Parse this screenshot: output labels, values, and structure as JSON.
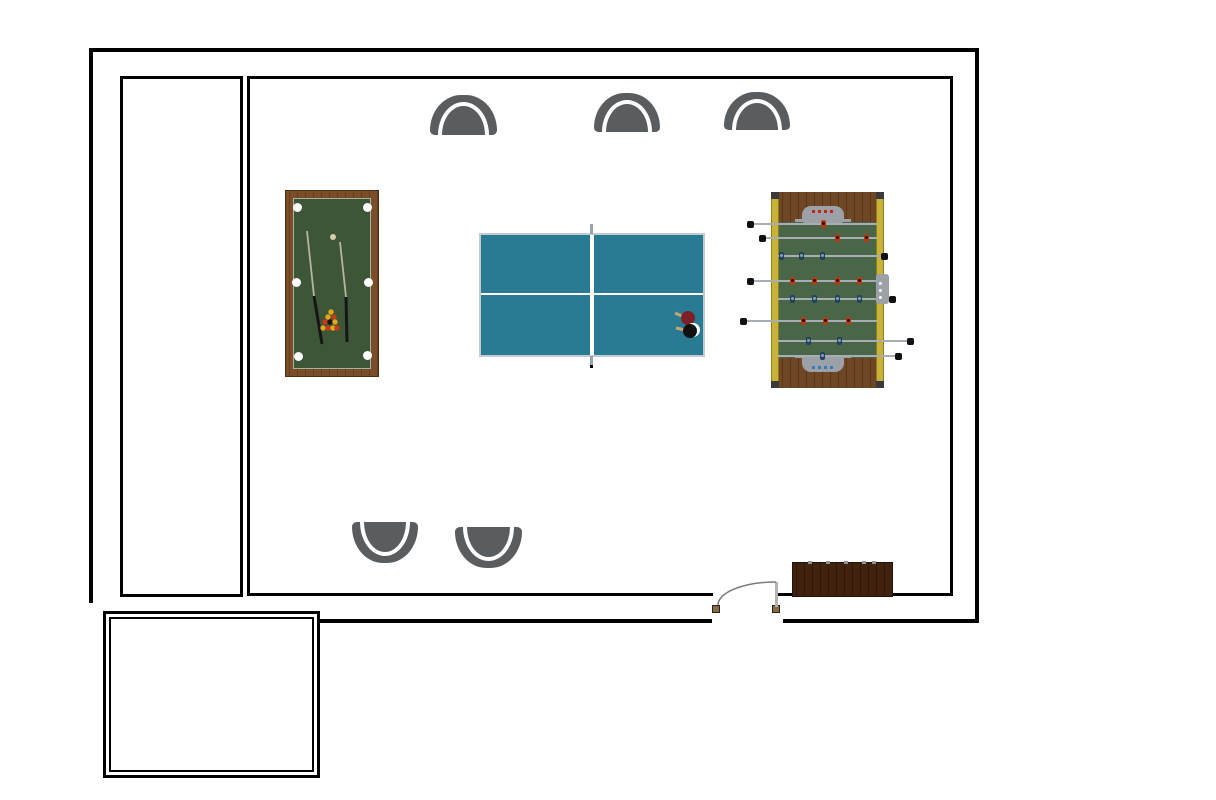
{
  "scene": {
    "title": "Game room floor plan",
    "canvas": {
      "w": 1216,
      "h": 800,
      "bg": "#ffffff"
    },
    "wall_color": "#000000",
    "walls": {
      "outer": [
        {
          "x": 89,
          "y": 48,
          "w": 890,
          "h": 4
        },
        {
          "x": 89,
          "y": 48,
          "w": 4,
          "h": 555
        },
        {
          "x": 975,
          "y": 48,
          "w": 4,
          "h": 575
        },
        {
          "x": 320,
          "y": 619,
          "w": 392,
          "h": 4
        },
        {
          "x": 783,
          "y": 619,
          "w": 196,
          "h": 4
        }
      ],
      "inner": [
        {
          "x": 120,
          "y": 76,
          "w": 123,
          "h": 3
        },
        {
          "x": 120,
          "y": 76,
          "w": 3,
          "h": 521
        },
        {
          "x": 240,
          "y": 76,
          "w": 3,
          "h": 521
        },
        {
          "x": 120,
          "y": 594,
          "w": 123,
          "h": 3
        },
        {
          "x": 247,
          "y": 76,
          "w": 706,
          "h": 3
        },
        {
          "x": 247,
          "y": 76,
          "w": 3,
          "h": 520
        },
        {
          "x": 950,
          "y": 76,
          "w": 3,
          "h": 520
        },
        {
          "x": 247,
          "y": 593,
          "w": 466,
          "h": 3
        },
        {
          "x": 778,
          "y": 593,
          "w": 175,
          "h": 3
        }
      ],
      "annex_outer": {
        "x": 103,
        "y": 611,
        "w": 217,
        "h": 167,
        "t": 3
      },
      "annex_inner": {
        "x": 109,
        "y": 617,
        "w": 205,
        "h": 155,
        "t": 2
      }
    },
    "door": {
      "jamb_color": "#8a6b3f",
      "panel_color": "#b4b4b4",
      "arc_color": "#7a7a7a",
      "jambs": [
        {
          "x": 712,
          "y": 605,
          "w": 8,
          "h": 8
        },
        {
          "x": 772,
          "y": 605,
          "w": 8,
          "h": 8
        }
      ],
      "panel": {
        "x": 775,
        "y": 582,
        "w": 3,
        "h": 25
      },
      "arc": {
        "x1": 718,
        "y1": 605,
        "x2": 776,
        "y2": 582,
        "rx": 58,
        "ry": 23
      }
    },
    "pool_table": {
      "rect": {
        "x": 285,
        "y": 190,
        "w": 94,
        "h": 187
      },
      "frame_color": "#7a4e28",
      "frame_streak": "#66401f",
      "felt": {
        "x": 293,
        "y": 198,
        "w": 78,
        "h": 171
      },
      "felt_color": "#3e5638",
      "felt_border": "#a9b0a0",
      "pocket_color": "#ffffff",
      "pocket_r": 4.5,
      "pockets": [
        {
          "x": 297,
          "y": 207
        },
        {
          "x": 367,
          "y": 207
        },
        {
          "x": 296,
          "y": 282
        },
        {
          "x": 368,
          "y": 282
        },
        {
          "x": 298,
          "y": 356
        },
        {
          "x": 367,
          "y": 355
        }
      ],
      "cue_ball": {
        "x": 333,
        "y": 237,
        "r": 3,
        "color": "#d8cda6"
      },
      "ball_r": 2.7,
      "rack_balls": [
        {
          "x": 331,
          "y": 312,
          "c": "#e0a81c"
        },
        {
          "x": 328,
          "y": 317,
          "c": "#e0a81c"
        },
        {
          "x": 334,
          "y": 317,
          "c": "#c63a17"
        },
        {
          "x": 325,
          "y": 322,
          "c": "#c63a17"
        },
        {
          "x": 330,
          "y": 322,
          "c": "#151515"
        },
        {
          "x": 335,
          "y": 322,
          "c": "#e0a81c"
        },
        {
          "x": 323,
          "y": 328,
          "c": "#e0a81c"
        },
        {
          "x": 328,
          "y": 328,
          "c": "#c63a17"
        },
        {
          "x": 333,
          "y": 328,
          "c": "#e0a81c"
        },
        {
          "x": 337,
          "y": 328,
          "c": "#c63a17"
        }
      ],
      "shaft_color": "#b9b39a",
      "butt_color": "#161616",
      "cues": [
        {
          "shaft": {
            "x1": 307,
            "y1": 231,
            "x2": 314,
            "y2": 296
          },
          "butt": {
            "x1": 314,
            "y1": 296,
            "x2": 322,
            "y2": 344
          }
        },
        {
          "shaft": {
            "x1": 340,
            "y1": 242,
            "x2": 346,
            "y2": 297
          },
          "butt": {
            "x1": 346,
            "y1": 297,
            "x2": 347,
            "y2": 342
          }
        }
      ]
    },
    "ping_pong_table": {
      "rect": {
        "x": 479,
        "y": 233,
        "w": 226,
        "h": 124
      },
      "surface_color": "#287b93",
      "border_color": "#c3cbd2",
      "line_color": "#ffffff",
      "center_line_y": 293,
      "net_line_x": 590,
      "net_overhang_color": "#9aa2aa",
      "net_top": {
        "x": 590,
        "y": 224,
        "w": 3,
        "h": 10
      },
      "net_bottom": {
        "x": 590,
        "y": 356,
        "w": 3,
        "h": 11
      },
      "net_dot": {
        "x": 590,
        "y": 365,
        "w": 3,
        "h": 3
      },
      "paddles": {
        "handle_color": "#c2a575",
        "red": {
          "cx": 688,
          "cy": 318,
          "r": 7,
          "color": "#7c2027",
          "handle": {
            "x1": 675,
            "y1": 313,
            "x2": 684,
            "y2": 317
          }
        },
        "black": {
          "cx": 690,
          "cy": 331,
          "r": 7,
          "color": "#111111",
          "rim_color": "#ffffff",
          "handle": {
            "x1": 676,
            "y1": 328,
            "x2": 685,
            "y2": 330
          }
        }
      }
    },
    "foosball_table": {
      "rect": {
        "x": 771,
        "y": 192,
        "w": 113,
        "h": 196
      },
      "rail_color": "#c8b23a",
      "rail_border": "#8f7d22",
      "rail_w": 8,
      "cap_color": "#3a3a3a",
      "wood_color": "#6f4724",
      "wood_streak": "#583619",
      "field": {
        "y1": 222,
        "y2": 358
      },
      "field_color": "#4a6648",
      "goal_color": "#9ba1a6",
      "goals": [
        {
          "x": 802,
          "y": 206,
          "w": 42,
          "h": 17,
          "bar": {
            "x": 795,
            "y": 219,
            "w": 56,
            "h": 3
          },
          "bead_y": 210,
          "bead_color": "#c22418"
        },
        {
          "x": 802,
          "y": 355,
          "w": 42,
          "h": 17,
          "bar": {
            "x": 795,
            "y": 355,
            "w": 56,
            "h": 3
          },
          "bead_y": 366,
          "bead_color": "#2f7fc2"
        }
      ],
      "bead_xs": [
        812,
        818,
        824,
        830
      ],
      "rod_color": "#a7adb2",
      "knob_color": "#111111",
      "player_colors": {
        "red": "#b83a12",
        "blue": "#24425c"
      },
      "player_head": {
        "red": "#2d1003",
        "blue": "#7fa3b8"
      },
      "rods": [
        {
          "y": 224,
          "x1": 754,
          "x2": 877,
          "knob": 750,
          "players": [
            {
              "x": 823,
              "t": "red"
            }
          ]
        },
        {
          "y": 238,
          "x1": 765,
          "x2": 877,
          "knob": 762,
          "players": [
            {
              "x": 837,
              "t": "red"
            },
            {
              "x": 866,
              "t": "red"
            }
          ]
        },
        {
          "y": 256,
          "x1": 778,
          "x2": 886,
          "knob": 884,
          "players": [
            {
              "x": 781,
              "t": "blue"
            },
            {
              "x": 801,
              "t": "blue"
            },
            {
              "x": 822,
              "t": "blue"
            }
          ]
        },
        {
          "y": 281,
          "x1": 754,
          "x2": 877,
          "knob": 750,
          "players": [
            {
              "x": 792,
              "t": "red"
            },
            {
              "x": 814,
              "t": "red"
            },
            {
              "x": 837,
              "t": "red"
            },
            {
              "x": 859,
              "t": "red"
            }
          ]
        },
        {
          "y": 299,
          "x1": 778,
          "x2": 894,
          "knob": 892,
          "players": [
            {
              "x": 792,
              "t": "blue"
            },
            {
              "x": 814,
              "t": "blue"
            },
            {
              "x": 837,
              "t": "blue"
            },
            {
              "x": 859,
              "t": "blue"
            }
          ]
        },
        {
          "y": 321,
          "x1": 746,
          "x2": 877,
          "knob": 743,
          "players": [
            {
              "x": 803,
              "t": "red"
            },
            {
              "x": 825,
              "t": "red"
            },
            {
              "x": 848,
              "t": "red"
            }
          ]
        },
        {
          "y": 341,
          "x1": 778,
          "x2": 912,
          "knob": 910,
          "players": [
            {
              "x": 808,
              "t": "blue"
            },
            {
              "x": 839,
              "t": "blue"
            }
          ]
        },
        {
          "y": 356,
          "x1": 778,
          "x2": 900,
          "knob": 898,
          "players": [
            {
              "x": 822,
              "t": "blue"
            }
          ]
        }
      ],
      "server": {
        "x": 876,
        "y": 274,
        "w": 13,
        "h": 30,
        "color": "#9ba1a6",
        "dot_color": "#ffffff",
        "dot_x": 879,
        "dot_ys": [
          282,
          289,
          296
        ]
      }
    },
    "chairs": {
      "color": "#595d60",
      "items": [
        {
          "x": 430,
          "y": 95,
          "w": 67,
          "h": 40,
          "facing": "down"
        },
        {
          "x": 594,
          "y": 93,
          "w": 66,
          "h": 39,
          "facing": "down"
        },
        {
          "x": 724,
          "y": 92,
          "w": 66,
          "h": 38,
          "facing": "down"
        },
        {
          "x": 352,
          "y": 522,
          "w": 66,
          "h": 41,
          "facing": "up"
        },
        {
          "x": 455,
          "y": 527,
          "w": 67,
          "h": 41,
          "facing": "up"
        }
      ]
    },
    "cabinet": {
      "x": 792,
      "y": 562,
      "w": 101,
      "h": 35,
      "color": "#40220f",
      "streak": "#301808",
      "tick_color": "#8f9496",
      "ticks": [
        808,
        826,
        844,
        862,
        872
      ]
    }
  }
}
